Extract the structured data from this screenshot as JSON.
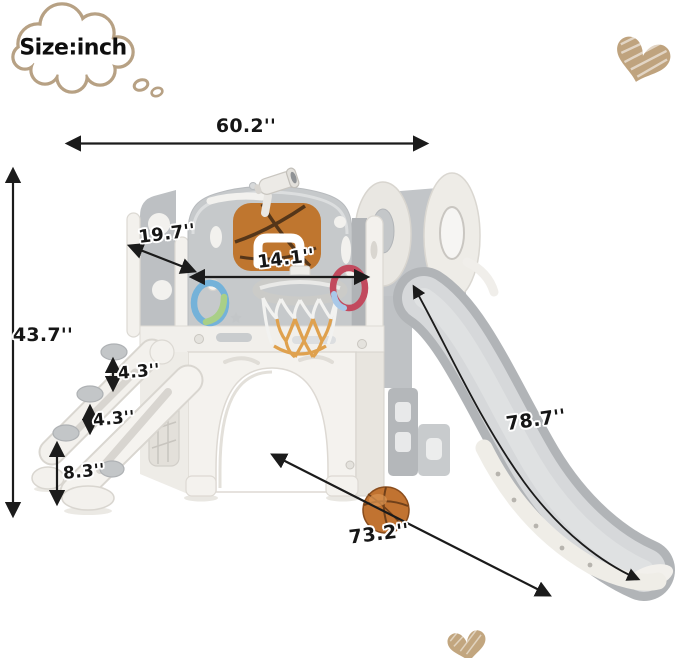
{
  "bubble": {
    "text": "Size:inch"
  },
  "dimensions": {
    "overall_width": "60.2''",
    "overall_height": "43.7''",
    "ladder_depth": "19.7''",
    "panel_width": "14.1''",
    "step_gap_upper": "4.3''",
    "step_gap_middle": "4.3''",
    "step_height_bottom": "8.3''",
    "slide_length": "78.7''",
    "base_diagonal": "73.2''"
  },
  "colors": {
    "accent_tan": "#b7a184",
    "line_black": "#1b1b1b",
    "plastic_grey": "#c6c9cb",
    "slide_grey": "#d5d7d9",
    "plastic_white": "#f3f1ed",
    "basketball_orange": "#c0712e",
    "net_orange": "#dfa14e",
    "ring_blue": "#74b2d9",
    "ring_green": "#a9cf87",
    "ring_red": "#c24a5e"
  },
  "decorations": {
    "thought_bubble_icon": "cloud-thought-bubble",
    "heart_top_right_icon": "scribble-heart",
    "heart_bottom_icon": "scribble-heart"
  }
}
